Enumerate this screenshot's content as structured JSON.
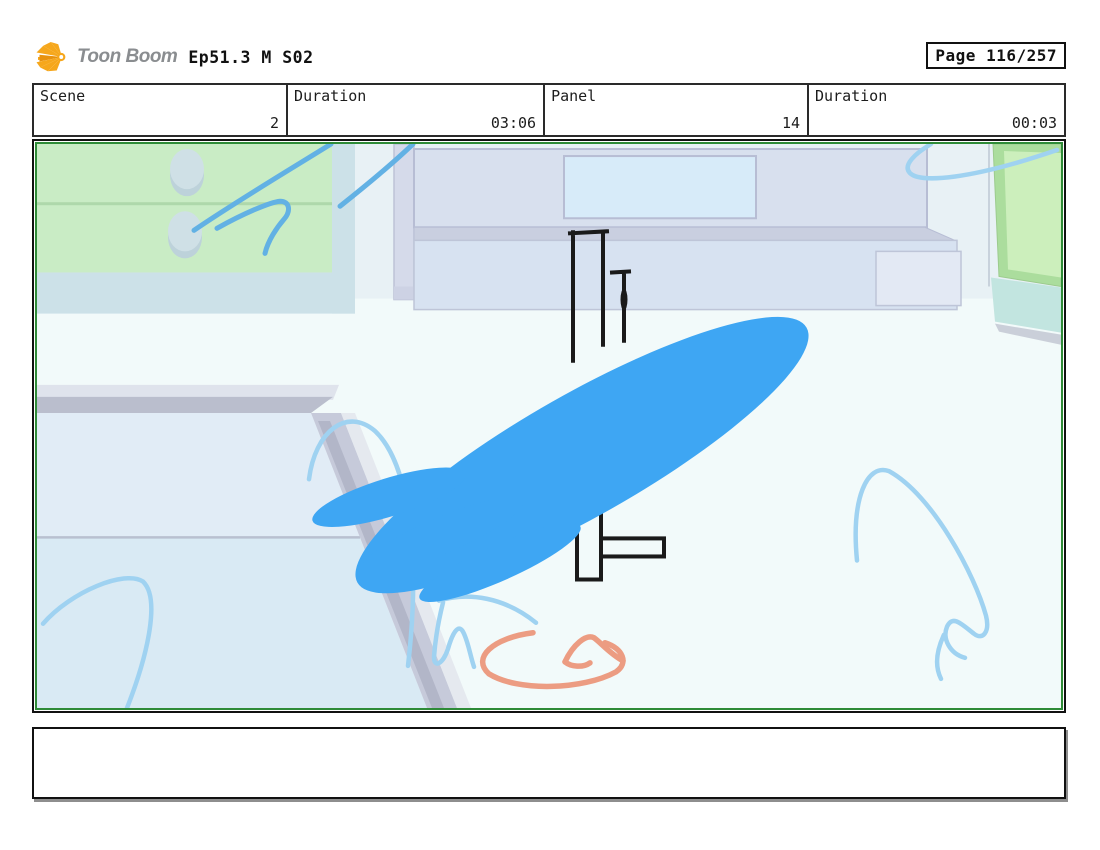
{
  "header": {
    "logo_text": "Toon Boom",
    "episode": "Ep51.3 M S02",
    "page_label": "Page 116/257"
  },
  "info_table": {
    "cells": [
      {
        "label": "Scene",
        "value": "2"
      },
      {
        "label": "Duration",
        "value": "03:06"
      },
      {
        "label": "Panel",
        "value": "14"
      },
      {
        "label": "Duration",
        "value": "00:03"
      }
    ]
  },
  "storyboard_panel": {
    "alt": "Room interior: green cabinet with knobs at left, wall shelf and counter at center-right, green door at right, table corner at lower left; black ink cross sketch in center covered by a large diagonal bright-blue brush stroke; light blue and coral sketch lines",
    "colors": {
      "panel_border_green": "#2e8b37",
      "ink": "#1a1a1a",
      "brush_blue": "#3ea6f3",
      "sketch_blue_strong": "#62b1e4",
      "sketch_blue_soft": "#9fd2f1",
      "coral": "#ec9c82",
      "cabinet_green": "#c9ecc5",
      "cabinet_base_teal": "#cce1e8",
      "door_green": "#abdd9d",
      "door_green_light": "#ccefbc",
      "door_teal": "#c2e5e0",
      "wall": "#e8f1f5",
      "floor": "#f2fafa",
      "furniture_gray": "#d8e0ee",
      "furniture_line": "#b7bdd4",
      "window_inset": "#d7ebf9",
      "counter_face": "#d7e2f1",
      "counter_inset": "#e3e9f4",
      "table_top": "#e1ecf6",
      "table_lower": "#d9eaf4",
      "table_trim": "#c6cada",
      "table_trim_dark": "#b2b6c8",
      "logo_yellow": "#f6a71c",
      "logo_text_gray": "#8a8d90"
    }
  },
  "caption_box": {
    "text": ""
  }
}
